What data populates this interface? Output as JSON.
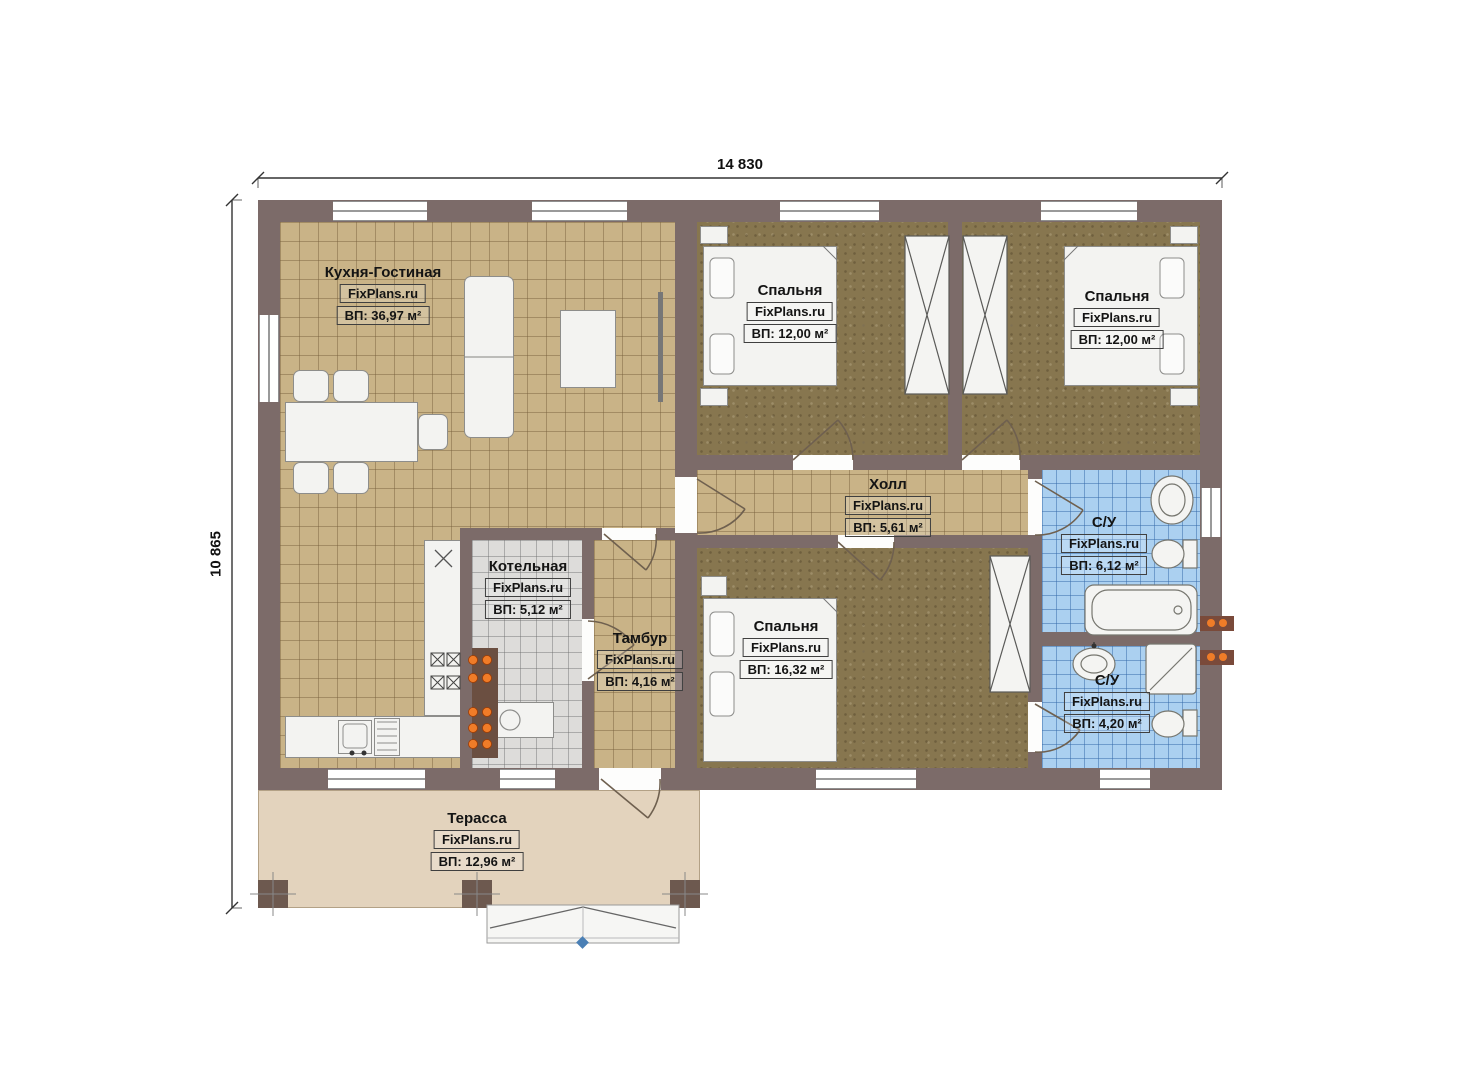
{
  "plan": {
    "watermark": "FixPlans.ru",
    "dimensions": {
      "width": "14 830",
      "height": "10 865"
    },
    "rooms": [
      {
        "id": "kitchen-living",
        "name": "Кухня-Гостиная",
        "area": "ВП: 36,97 м²"
      },
      {
        "id": "bedroom-1",
        "name": "Спальня",
        "area": "ВП: 12,00 м²"
      },
      {
        "id": "bedroom-2",
        "name": "Спальня",
        "area": "ВП: 12,00 м²"
      },
      {
        "id": "hall",
        "name": "Холл",
        "area": "ВП: 5,61 м²"
      },
      {
        "id": "boiler-room",
        "name": "Котельная",
        "area": "ВП: 5,12 м²"
      },
      {
        "id": "vestibule",
        "name": "Тамбур",
        "area": "ВП: 4,16 м²"
      },
      {
        "id": "bedroom-3",
        "name": "Спальня",
        "area": "ВП: 16,32 м²"
      },
      {
        "id": "bathroom-1",
        "name": "С/У",
        "area": "ВП: 6,12 м²"
      },
      {
        "id": "bathroom-2",
        "name": "С/У",
        "area": "ВП: 4,20 м²"
      },
      {
        "id": "terrace",
        "name": "Терасса",
        "area": "ВП: 12,96 м²"
      }
    ],
    "colors": {
      "wall": "#7c6b69",
      "tile_floor": "#c9b387",
      "bedroom_floor": "#87764f",
      "bath_floor": "#abd0f0",
      "boiler_floor": "#dddcda",
      "terrace_floor": "#e3d3bd",
      "column": "#6d594f",
      "accent_orange": "#f07c28",
      "fixture": "#f3f3f1"
    }
  }
}
